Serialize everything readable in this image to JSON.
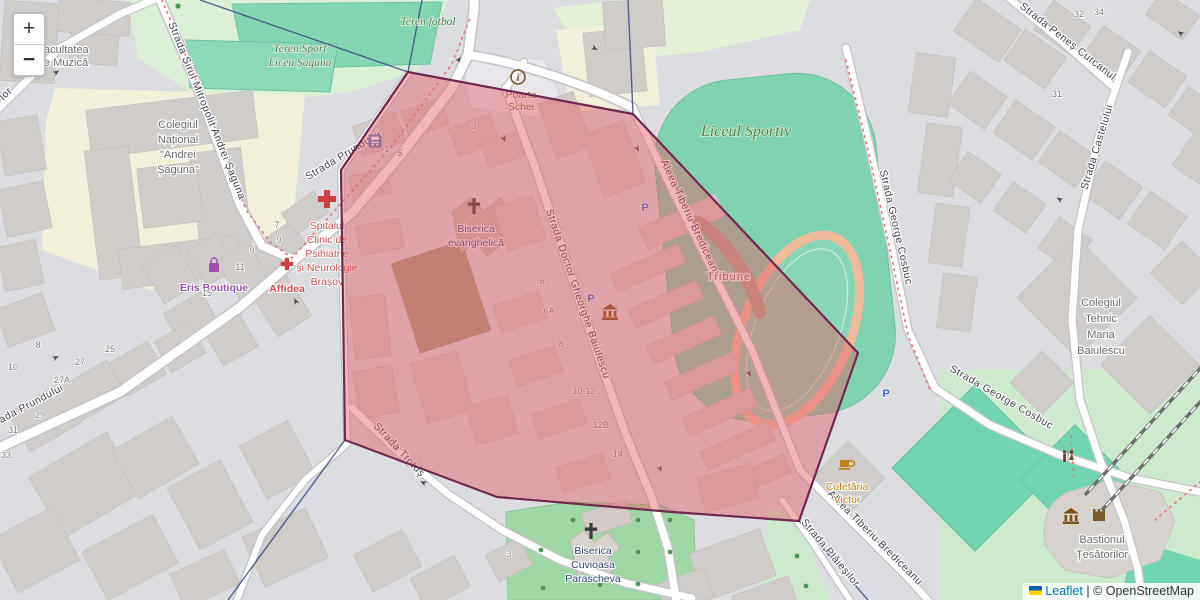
{
  "controls": {
    "zoom_in": "+",
    "zoom_out": "−"
  },
  "attribution": {
    "leaflet": "Leaflet",
    "separator": "|",
    "copyright": "© OpenStreetMap"
  },
  "colors": {
    "overlay_fill": "#e35e68",
    "overlay_stroke": "#6f2950",
    "pitch_green": "#7fd3b0",
    "park_green": "#dcf0d7",
    "school_yellow": "#f2efda",
    "building_gray": "#cfccca",
    "boundary_blue": "#3c4a86",
    "route_red": "#e87b7b",
    "leaflet_link_blue": "#0078a8"
  },
  "streets": {
    "prundului": "Strada Prundului",
    "sirul": "Strada Șirul Mitropolit Andrei Șaguna",
    "penes_curcanul": "Strada Peneș Curcanul",
    "castelului": "Strada Castelului",
    "george_cosbuc": "Strada George Cosbuc",
    "baiulescu": "Strada Doctor Gheorghe Baiulescu",
    "brediceanu": "Aleea Tiberiu Brediceanu",
    "trotus": "Strada Trotuș",
    "plaiesilor": "Strada Plăieșilor",
    "partial_lor": "lor"
  },
  "places": {
    "facultatea": {
      "lines": [
        "Facultatea",
        "de Muzică"
      ]
    },
    "teren_fotbol": {
      "text": "Teren fotbol"
    },
    "teren_sport": {
      "lines": [
        "Teren Sport",
        "Liceu Șaguna"
      ]
    },
    "colegiul_national": {
      "lines": [
        "Colegiul",
        "Național",
        "\"Andrei",
        "Șaguna\""
      ]
    },
    "poarta_schei": {
      "lines": [
        "Poarta",
        "Schei"
      ]
    },
    "liceul_sportiv": {
      "text": "Liceul Sportiv"
    },
    "spitalul": {
      "lines": [
        "Spitalul",
        "Clinic de",
        "Psihiatrie",
        "și Neurologie",
        "Brașov"
      ]
    },
    "affidea": {
      "text": "Affidea"
    },
    "eris_boutique": {
      "text": "Eris Boutique"
    },
    "biserica_evanghelica": {
      "lines": [
        "Biserica",
        "evanghelică"
      ]
    },
    "tribune": {
      "text": "Tribune"
    },
    "colegiul_tehnic": {
      "lines": [
        "Colegiul",
        "Tehnic",
        "Maria",
        "Baiulescu"
      ]
    },
    "cofetaria": {
      "lines": [
        "Cofetăria",
        "Victor"
      ]
    },
    "bastionul": {
      "lines": [
        "Bastionul",
        "Țesătorilor"
      ]
    },
    "parascheva": {
      "lines": [
        "Biserica",
        "Cuvioasa",
        "Parascheva"
      ]
    }
  },
  "house_numbers": [
    "8",
    "10",
    "25",
    "27",
    "27A",
    "29",
    "31",
    "33",
    "7",
    "9",
    "9",
    "11",
    "15",
    "1",
    "5",
    "3",
    "6",
    "6A",
    "8",
    "10-12",
    "12B",
    "14",
    "3",
    "32",
    "34",
    "31"
  ],
  "icons": {
    "parking_letter": "P",
    "info_letter": "i"
  }
}
